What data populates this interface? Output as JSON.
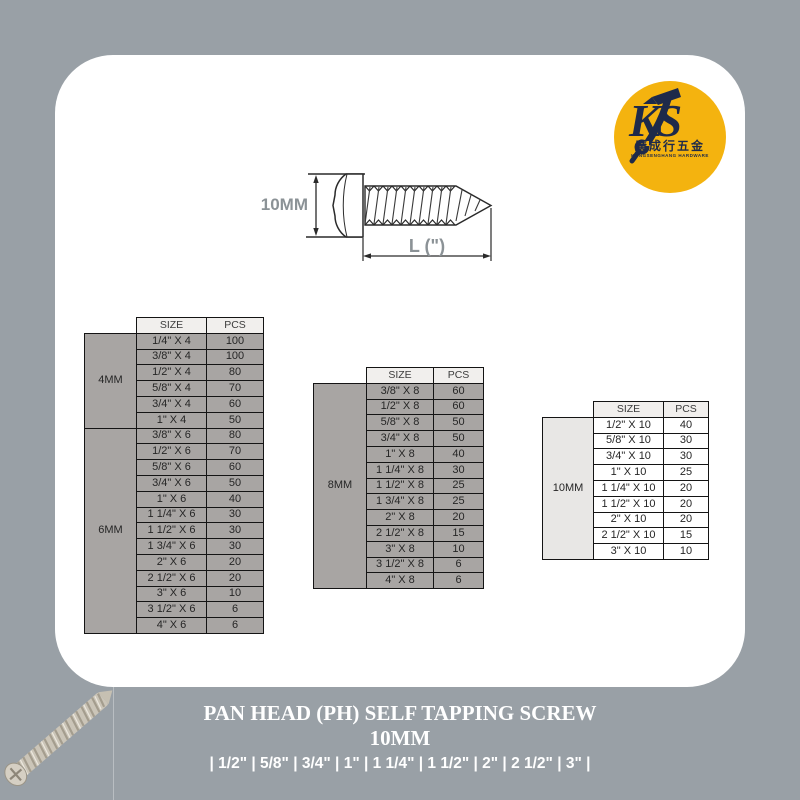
{
  "colors": {
    "background": "#99A0A6",
    "card": "#FFFFFF",
    "table_cell_gray": "#A8A5A3",
    "table_header_bg": "#F1EFED",
    "table10_cell": "#FFFFFF",
    "table10_label": "#E8E7E5",
    "logo_yellow": "#F4B30F",
    "logo_navy": "#1E2A4A",
    "dim_label_gray": "#8B9296",
    "footer_text": "#FFFFFF"
  },
  "logo": {
    "monogram": "KS",
    "chinese_name": "廣成行五金",
    "english_name": "KONGSENGHANG HARDWARE"
  },
  "diagram": {
    "head_diameter_label": "10MM",
    "length_label": "L (\")"
  },
  "tables": [
    {
      "headers": [
        "SIZE",
        "PCS"
      ],
      "groups": [
        {
          "label": "4MM",
          "rows": [
            [
              "1/4\" X 4",
              "100"
            ],
            [
              "3/8\" X 4",
              "100"
            ],
            [
              "1/2\" X 4",
              "80"
            ],
            [
              "5/8\" X 4",
              "70"
            ],
            [
              "3/4\" X 4",
              "60"
            ],
            [
              "1\" X 4",
              "50"
            ]
          ]
        },
        {
          "label": "6MM",
          "rows": [
            [
              "3/8\" X 6",
              "80"
            ],
            [
              "1/2\" X 6",
              "70"
            ],
            [
              "5/8\" X 6",
              "60"
            ],
            [
              "3/4\" X 6",
              "50"
            ],
            [
              "1\" X 6",
              "40"
            ],
            [
              "1 1/4\" X 6",
              "30"
            ],
            [
              "1 1/2\" X 6",
              "30"
            ],
            [
              "1 3/4\" X 6",
              "30"
            ],
            [
              "2\" X 6",
              "20"
            ],
            [
              "2 1/2\" X 6",
              "20"
            ],
            [
              "3\" X 6",
              "10"
            ],
            [
              "3 1/2\" X 6",
              "6"
            ],
            [
              "4\" X 6",
              "6"
            ]
          ]
        }
      ]
    },
    {
      "headers": [
        "SIZE",
        "PCS"
      ],
      "groups": [
        {
          "label": "8MM",
          "rows": [
            [
              "3/8\" X 8",
              "60"
            ],
            [
              "1/2\" X 8",
              "60"
            ],
            [
              "5/8\" X 8",
              "50"
            ],
            [
              "3/4\" X 8",
              "50"
            ],
            [
              "1\" X 8",
              "40"
            ],
            [
              "1 1/4\" X 8",
              "30"
            ],
            [
              "1 1/2\" X 8",
              "25"
            ],
            [
              "1 3/4\" X 8",
              "25"
            ],
            [
              "2\" X 8",
              "20"
            ],
            [
              "2 1/2\" X 8",
              "15"
            ],
            [
              "3\" X 8",
              "10"
            ],
            [
              "3 1/2\" X 8",
              "6"
            ],
            [
              "4\" X 8",
              "6"
            ]
          ]
        }
      ]
    },
    {
      "headers": [
        "SIZE",
        "PCS"
      ],
      "groups": [
        {
          "label": "10MM",
          "rows": [
            [
              "1/2\" X 10",
              "40"
            ],
            [
              "5/8\" X 10",
              "30"
            ],
            [
              "3/4\" X 10",
              "30"
            ],
            [
              "1\" X 10",
              "25"
            ],
            [
              "1 1/4\" X 10",
              "20"
            ],
            [
              "1 1/2\" X 10",
              "20"
            ],
            [
              "2\" X 10",
              "20"
            ],
            [
              "2 1/2\" X 10",
              "15"
            ],
            [
              "3\" X 10",
              "10"
            ]
          ]
        }
      ]
    }
  ],
  "footer": {
    "title": "PAN HEAD (PH) SELF TAPPING SCREW",
    "subtitle": "10MM",
    "sizes_line": "| 1/2\" | 5/8\" | 3/4\" | 1\" | 1 1/4\" | 1 1/2\" | 2\" | 2 1/2\" | 3\" |"
  }
}
